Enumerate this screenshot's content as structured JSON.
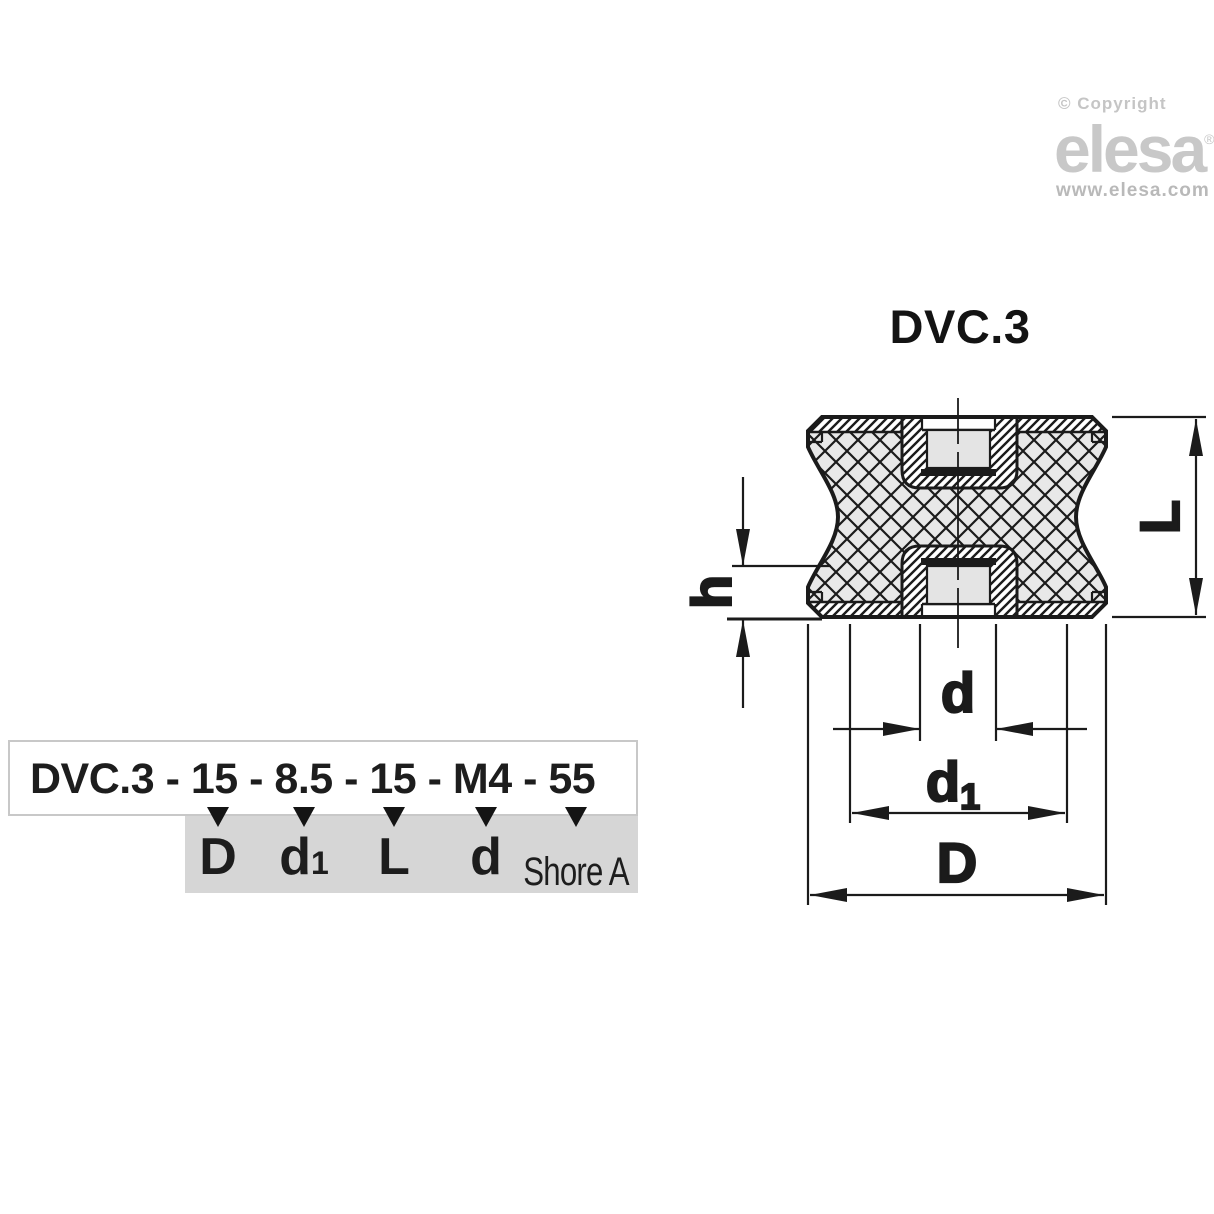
{
  "logo": {
    "copyright": "© Copyright",
    "brand": "elesa",
    "registered": "®",
    "website": "www.elesa.com"
  },
  "drawing": {
    "title": "DVC.3",
    "dim_L": "L",
    "dim_h": "h",
    "dim_d": "d",
    "dim_d1_base": "d",
    "dim_d1_sub": "1",
    "dim_D": "D"
  },
  "ordering": {
    "code": "DVC.3 - 15 - 8.5 - 15 - M4 - 55",
    "columns": [
      {
        "base": "D",
        "sub": ""
      },
      {
        "base": "d",
        "sub": "1"
      },
      {
        "base": "L",
        "sub": ""
      },
      {
        "base": "d",
        "sub": ""
      },
      {
        "base": "Shore A",
        "sub": ""
      }
    ]
  },
  "colors": {
    "line": "#1b1b1b",
    "body_fill": "#e8e8e8",
    "hole_fill": "#e4e4e4",
    "legend_bg": "#d6d6d6",
    "box_border": "#c8c8c8",
    "logo_gray": "#c8c8c8",
    "website_gray": "#b9b9b9"
  }
}
